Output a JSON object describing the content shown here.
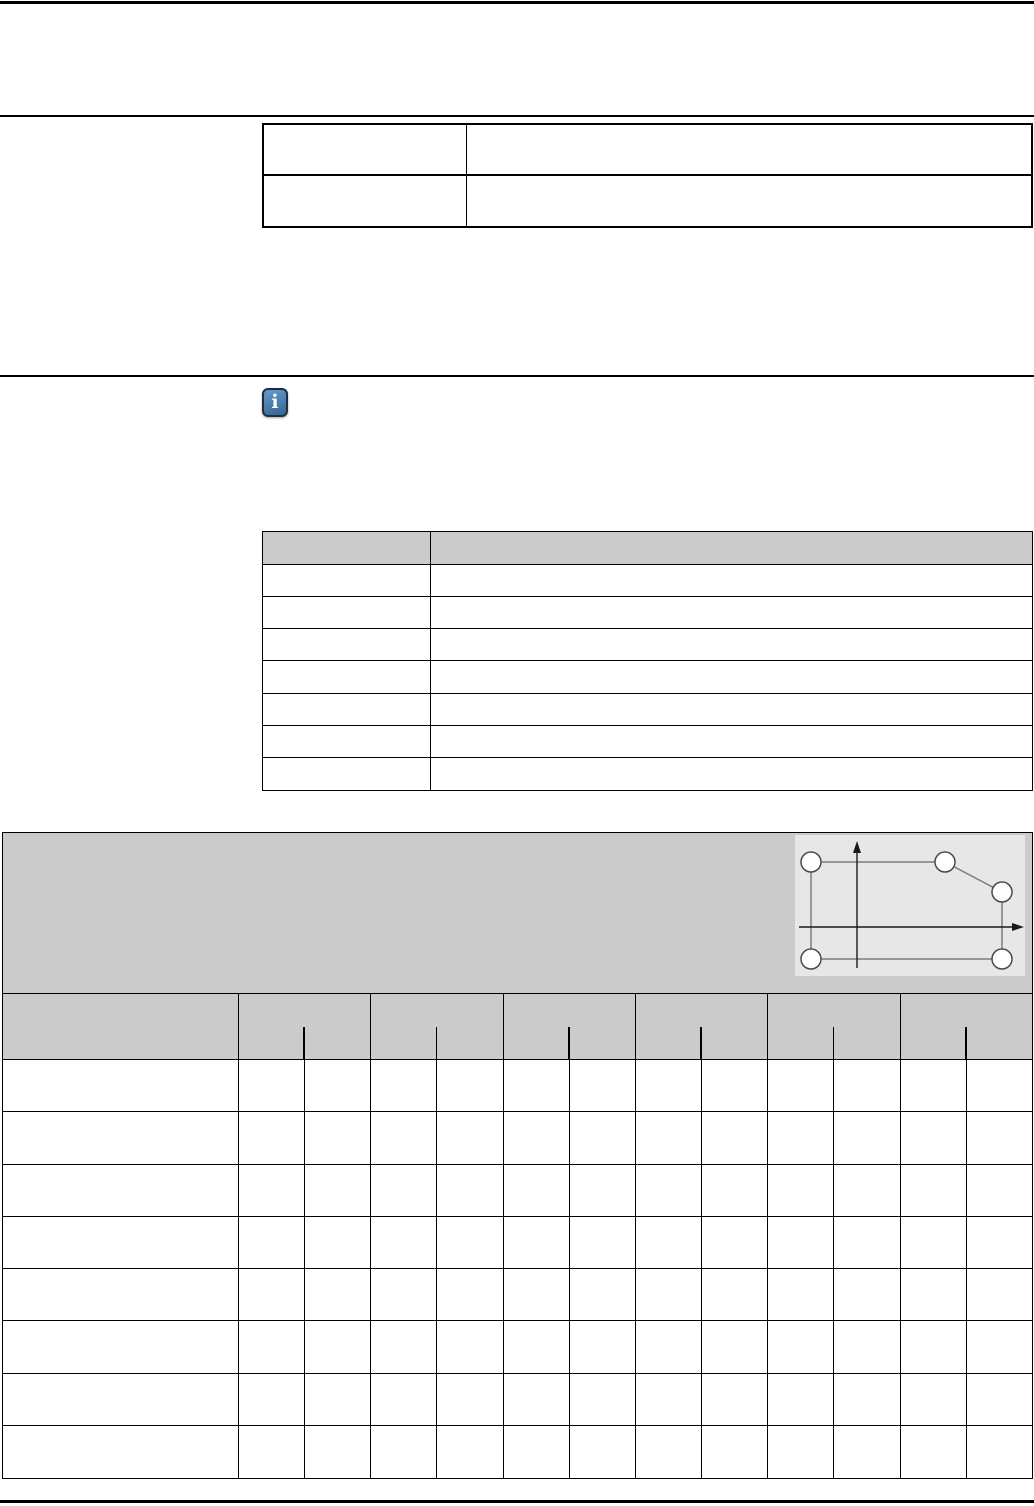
{
  "page": {
    "kind": "technical-document-template",
    "width_px": 1034,
    "height_px": 1506,
    "background": "#ffffff"
  },
  "colors": {
    "rule": "#000000",
    "table_border": "#000000",
    "table_header_fill": "#cbcbcb",
    "figure_panel_fill": "#cbcbcb",
    "figure_image_fill": "#e7e7e7",
    "figure_line": "#7d7d7d",
    "figure_axis": "#1a1a1a",
    "figure_node_fill": "#ffffff",
    "figure_node_stroke": "#4a4a4a",
    "info_icon_fill_top": "#6699cc",
    "info_icon_fill_bottom": "#35648f",
    "info_icon_border": "#1d2f3f",
    "info_icon_glyph_color": "#ffffff"
  },
  "icons": {
    "info": {
      "name": "info-icon",
      "glyph": "i"
    }
  },
  "top_table": {
    "rows": 2,
    "columns": 2,
    "cells": [
      [
        "",
        ""
      ],
      [
        "",
        ""
      ]
    ]
  },
  "spec_table": {
    "header": [
      "",
      ""
    ],
    "data_rows": 7,
    "columns": 2,
    "cells": [
      [
        "",
        ""
      ],
      [
        "",
        ""
      ],
      [
        "",
        ""
      ],
      [
        "",
        ""
      ],
      [
        "",
        ""
      ],
      [
        "",
        ""
      ],
      [
        "",
        ""
      ]
    ]
  },
  "matrix_table": {
    "label_column_header": "",
    "column_groups": 6,
    "subcolumns_per_group": 2,
    "data_rows": 8,
    "row_labels": [
      "",
      "",
      "",
      "",
      "",
      "",
      "",
      ""
    ]
  },
  "figure": {
    "name": "derating-diagram",
    "canvas": {
      "width": 230,
      "height": 141
    },
    "y_axis": {
      "x": 62,
      "y_top": 9,
      "y_bottom": 133
    },
    "x_axis": {
      "y": 92,
      "x_left": 4,
      "x_right": 226
    },
    "node_radius": 10,
    "polygon_nodes": [
      {
        "x": 16,
        "y": 27
      },
      {
        "x": 150,
        "y": 27
      },
      {
        "x": 207,
        "y": 57
      },
      {
        "x": 207,
        "y": 124
      },
      {
        "x": 16,
        "y": 124
      }
    ]
  }
}
